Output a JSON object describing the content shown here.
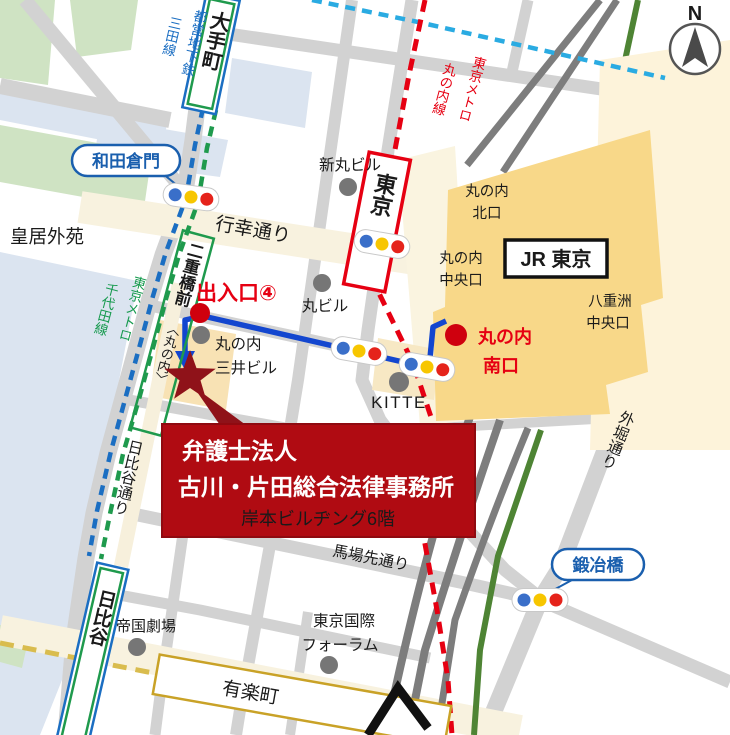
{
  "compass": {
    "north": "N"
  },
  "stations": {
    "otemachi": "大手町",
    "tokyo": "東京",
    "jr_tokyo": "JR 東京",
    "nijubashimae": "二重橋前",
    "nijubashimae_sub": "〈丸の内〉",
    "hibiya": "日比谷",
    "yurakucho": "有楽町"
  },
  "gates": {
    "wadakuramon": "和田倉門",
    "kajibashi": "鍛冶橋"
  },
  "metro_lines": {
    "mita_operator": "都営地下鉄",
    "mita_name": "三田線",
    "marunouchi_operator": "東京メトロ",
    "marunouchi_name": "丸の内線",
    "chiyoda_operator": "東京メトロ",
    "chiyoda_name": "千代田線"
  },
  "exits": {
    "exit4": "出入口④",
    "kita_l1": "丸の内",
    "kita_l2": "北口",
    "chuo_l1": "丸の内",
    "chuo_l2": "中央口",
    "yaesu_l1": "八重洲",
    "yaesu_l2": "中央口",
    "minami_l1": "丸の内",
    "minami_l2": "南口"
  },
  "streets": {
    "gyoko": "行幸通り",
    "babasaki": "馬場先通り",
    "sotobori": "外堀通り",
    "hibiya_dori": "日比谷通り"
  },
  "places": {
    "kokyo_gaien": "皇居外苑",
    "shinmaru": "新丸ビル",
    "marubiru": "丸ビル",
    "mitsui_l1": "丸の内",
    "mitsui_l2": "三井ビル",
    "kitte": "KITTE",
    "teigeki": "帝国劇場",
    "forum_l1": "東京国際",
    "forum_l2": "フォーラム"
  },
  "callout": {
    "line1": "弁護士法人",
    "line2": "古川・片田総合法律事務所",
    "line3": "岸本ビルヂング6階"
  },
  "colors": {
    "red": "#e60012",
    "route-blue": "#1346cf",
    "mita-blue": "#1b6ec2",
    "chiyoda-green": "#1f9a4d",
    "tozai-cyan": "#2aabe2",
    "gold": "#d9bc4e",
    "gold-border": "#c9a227",
    "station-yellow": "#f8d889",
    "dark-red": "#8f1219",
    "callout-red": "#b00b12",
    "pill-blue": "#1a5fae",
    "road": "#d2d2d2",
    "rail": "#7d7d7d",
    "rail-green": "#4e8434",
    "park": "#cfe3c3",
    "moat": "#dbe4f0",
    "cream": "#f8f2df",
    "block-orange": "#f8e2b4",
    "signal-blue": "#3a6fc9",
    "signal-yellow": "#f7c600",
    "signal-red": "#e5231b"
  }
}
